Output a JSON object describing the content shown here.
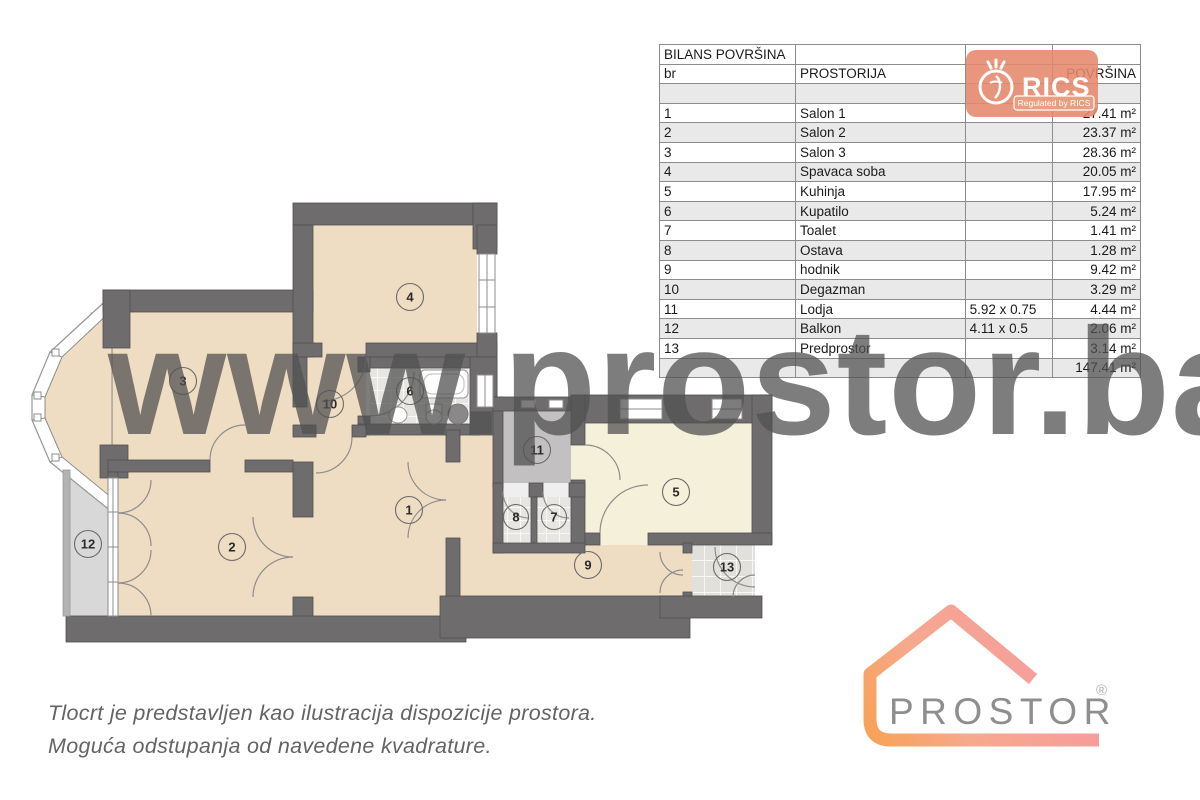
{
  "table": {
    "title": "BILANS POVRŠINA",
    "columns": [
      "br",
      "PROSTORIJA",
      "",
      "POVRŠINA"
    ],
    "rows": [
      {
        "br": "1",
        "name": "Salon 1",
        "dims": "",
        "area": "27.41 m²"
      },
      {
        "br": "2",
        "name": "Salon 2",
        "dims": "",
        "area": "23.37 m²"
      },
      {
        "br": "3",
        "name": "Salon 3",
        "dims": "",
        "area": "28.36 m²"
      },
      {
        "br": "4",
        "name": "Spavaca soba",
        "dims": "",
        "area": "20.05 m²"
      },
      {
        "br": "5",
        "name": "Kuhinja",
        "dims": "",
        "area": "17.95 m²"
      },
      {
        "br": "6",
        "name": "Kupatilo",
        "dims": "",
        "area": "5.24 m²"
      },
      {
        "br": "7",
        "name": "Toalet",
        "dims": "",
        "area": "1.41 m²"
      },
      {
        "br": "8",
        "name": "Ostava",
        "dims": "",
        "area": "1.28 m²"
      },
      {
        "br": "9",
        "name": "hodnik",
        "dims": "",
        "area": "9.42 m²"
      },
      {
        "br": "10",
        "name": "Degazman",
        "dims": "",
        "area": "3.29 m²"
      },
      {
        "br": "11",
        "name": "Lodja",
        "dims": "5.92 x 0.75",
        "area": "4.44 m²"
      },
      {
        "br": "12",
        "name": "Balkon",
        "dims": "4.11 x 0.5",
        "area": "2.06 m²"
      },
      {
        "br": "13",
        "name": "Predprostor",
        "dims": "",
        "area": "3.14 m²"
      }
    ],
    "total_area": "147.41 m²"
  },
  "watermark": "www.prostor.ba",
  "rics_logo": {
    "name": "RICS",
    "tagline": "Regulated by RICS",
    "color": "#e5876b"
  },
  "prostor_logo": {
    "text": "PROSTOR",
    "registered": "®",
    "text_color": "#8e8e8e",
    "gradient_start": "#f7a254",
    "gradient_end": "#f69d9d"
  },
  "disclaimer": {
    "line1": "Tlocrt je predstavljen kao ilustracija dispozicije prostora.",
    "line2": "Moguća odstupanja od navedene kvadrature."
  },
  "floor_plan": {
    "palette": {
      "wall": "#6e6c6d",
      "room_beige": "#eeddc2",
      "kitchen_cream": "#f4f0da",
      "loggia_gray": "#c2c0c1",
      "balcony_gray": "#d8d8d8",
      "tile": "#e8e6e2"
    },
    "rooms": [
      {
        "number": "1",
        "name": "Salon 1"
      },
      {
        "number": "2",
        "name": "Salon 2"
      },
      {
        "number": "3",
        "name": "Salon 3"
      },
      {
        "number": "4",
        "name": "Spavaca soba"
      },
      {
        "number": "5",
        "name": "Kuhinja"
      },
      {
        "number": "6",
        "name": "Kupatilo"
      },
      {
        "number": "7",
        "name": "Toalet"
      },
      {
        "number": "8",
        "name": "Ostava"
      },
      {
        "number": "9",
        "name": "hodnik"
      },
      {
        "number": "10",
        "name": "Degazman"
      },
      {
        "number": "11",
        "name": "Lodja"
      },
      {
        "number": "12",
        "name": "Balkon"
      },
      {
        "number": "13",
        "name": "Predprostor"
      }
    ]
  }
}
